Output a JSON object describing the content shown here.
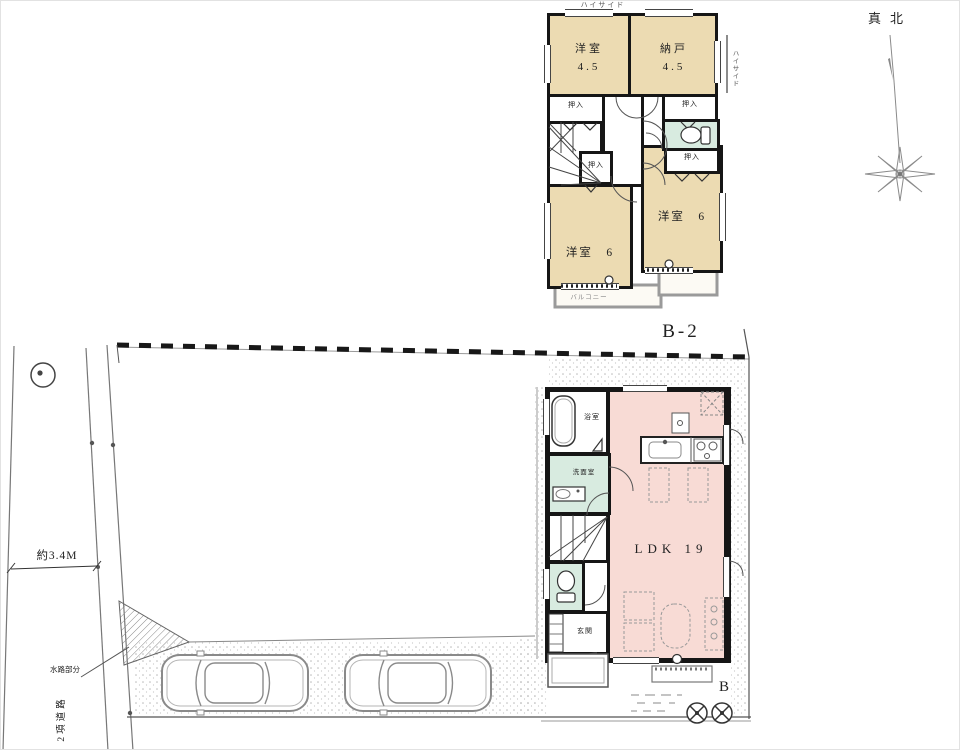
{
  "palette": {
    "wall": "#161616",
    "room_tan": "#ecdbb2",
    "room_pink": "#f8dbd5",
    "room_green": "#d8ebe0",
    "line_gray": "#777777"
  },
  "compass": {
    "north_label": "真北"
  },
  "floor2": {
    "plan_label": "B-2",
    "highside_top": "ハイサイド",
    "highside_right": "ハイサイド",
    "room1_name": "洋室",
    "room1_size": "4.5",
    "room2_name": "納戸",
    "room2_size": "4.5",
    "room3_label": "洋室　6",
    "room4_label": "洋室　6",
    "closet_label": "押入",
    "balcony_label": "バルコニー"
  },
  "floor1": {
    "ldk_label": "LDK 19",
    "bath_label": "浴室",
    "washroom_label": "洗面室",
    "entrance_label": "玄関",
    "corner_label": "B"
  },
  "site": {
    "road_width_label": "約3.4M",
    "road_type_label": "2項道路",
    "waterway_label": "水路部分"
  }
}
